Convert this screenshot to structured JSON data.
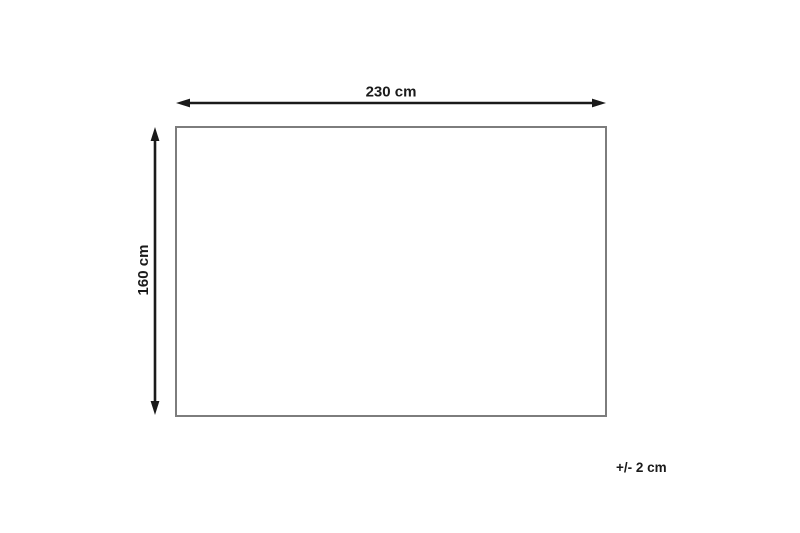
{
  "diagram": {
    "shape": "rectangle",
    "width_label": "230 cm",
    "height_label": "160 cm",
    "tolerance_label": "+/- 2 cm",
    "colors": {
      "arrow": "#1a1a1a",
      "text": "#1a1a1a",
      "rectangle_border": "#7d7d7d",
      "background": "#ffffff"
    }
  }
}
